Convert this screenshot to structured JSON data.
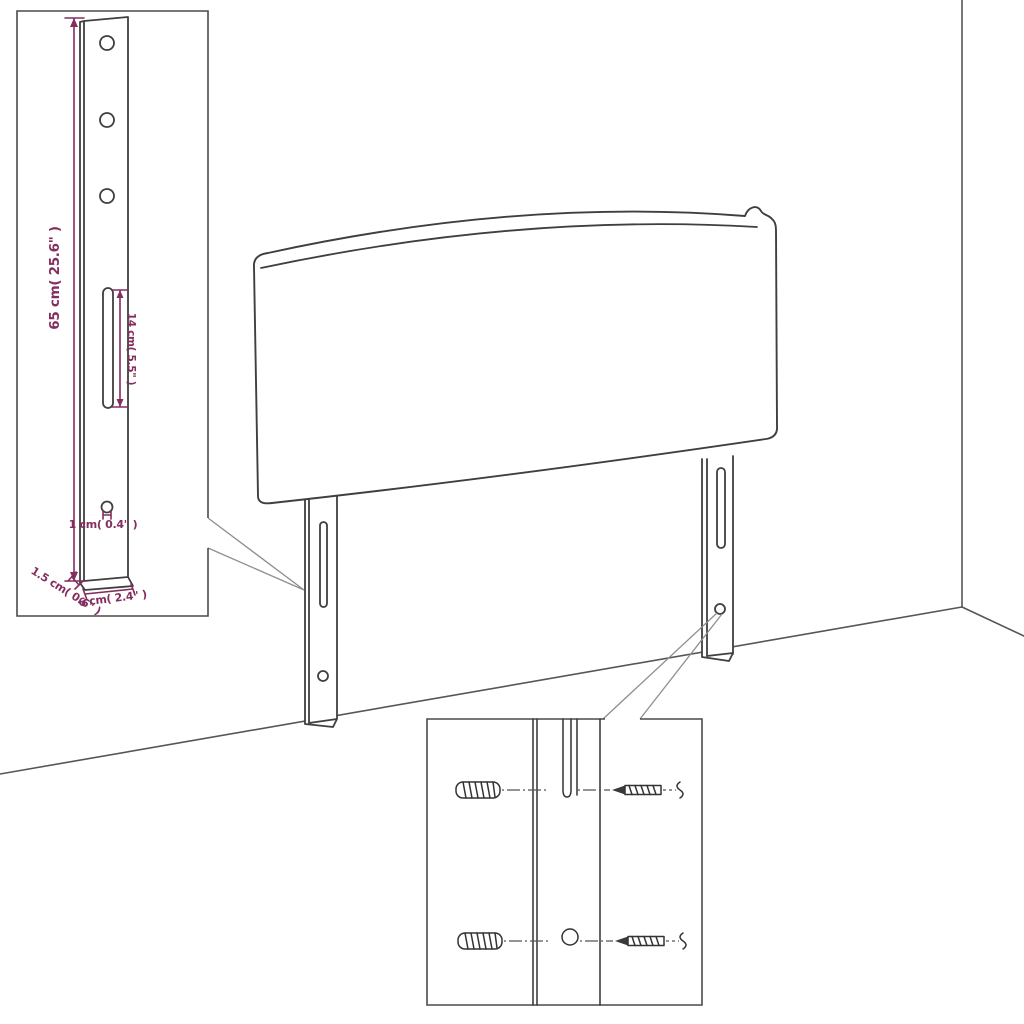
{
  "title": "Headboard wall-mounting assembly diagram",
  "colors": {
    "line": "#3f3f3f",
    "dimension": "#842D5F",
    "background": "#ffffff"
  },
  "dimensions": {
    "leg_height": "65 cm( 25.6\" )",
    "slot_length": "14 cm( 5.5\" )",
    "hole_diameter": "1 cm( 0.4\" )",
    "leg_thickness": "1.5 cm( 0.6\" )",
    "leg_width": "6 cm( 2.4\" )"
  }
}
